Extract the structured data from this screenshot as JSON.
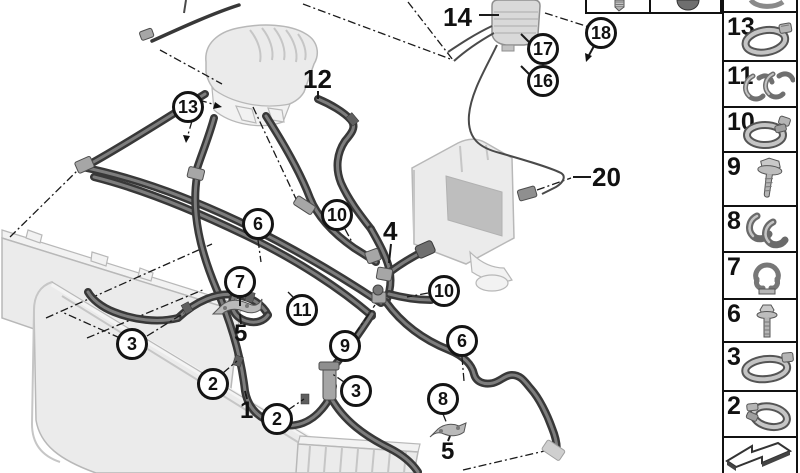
{
  "colors": {
    "outline": "#111111",
    "hose_dark": "#383838",
    "hose_highlight": "#7d7d7d",
    "ghost_fill": "#ebebeb",
    "ghost_line": "#b8b8b8",
    "metal": "#a6a6a6"
  },
  "diagram": {
    "circled_callouts": [
      {
        "label": "13"
      },
      {
        "label": "18"
      },
      {
        "label": "17"
      },
      {
        "label": "16"
      },
      {
        "label": "10"
      },
      {
        "label": "6"
      },
      {
        "label": "7"
      },
      {
        "label": "11"
      },
      {
        "label": "9"
      },
      {
        "label": "10"
      },
      {
        "label": "6"
      },
      {
        "label": "3"
      },
      {
        "label": "2"
      },
      {
        "label": "2"
      },
      {
        "label": "3"
      },
      {
        "label": "8"
      }
    ],
    "plain_callouts": [
      {
        "label": "14"
      },
      {
        "label": "12"
      },
      {
        "label": "4"
      },
      {
        "label": "5"
      },
      {
        "label": "1"
      },
      {
        "label": "5"
      },
      {
        "label": "20"
      }
    ]
  },
  "sidebar": {
    "items": [
      {
        "number": "13",
        "icon": "hose-clamp"
      },
      {
        "number": "11",
        "icon": "clip-pair"
      },
      {
        "number": "10",
        "icon": "spring-clamp"
      },
      {
        "number": "9",
        "icon": "flange-screw"
      },
      {
        "number": "8",
        "icon": "clamp-pair"
      },
      {
        "number": "7",
        "icon": "holder-clip"
      },
      {
        "number": "6",
        "icon": "flange-bolt"
      },
      {
        "number": "3",
        "icon": "hose-clamp"
      },
      {
        "number": "2",
        "icon": "spring-clamp-angled"
      }
    ],
    "partial_top_icon": "clamp-partial",
    "footer_icon": "prev-page-arrow"
  },
  "top_box": {
    "left_icon": "screw-bottom",
    "right_icon": "plug-bottom"
  }
}
